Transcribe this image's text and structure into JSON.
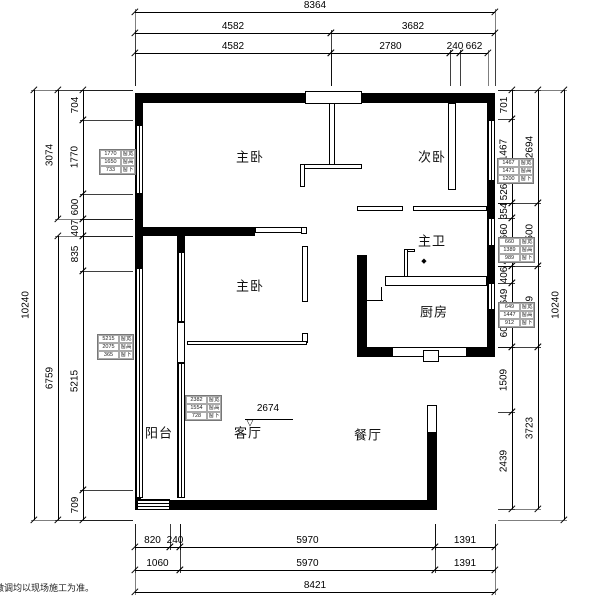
{
  "footnote": "微调均以现场施工为准。",
  "colors": {
    "wall": "#000000",
    "line": "#000000",
    "background": "#ffffff"
  },
  "plan": {
    "rooms": [
      {
        "id": "master-bedroom-top",
        "label": "主卧",
        "x": 250,
        "y": 156
      },
      {
        "id": "second-bedroom",
        "label": "次卧",
        "x": 432,
        "y": 156
      },
      {
        "id": "master-bath",
        "label": "主卫",
        "x": 432,
        "y": 240
      },
      {
        "id": "kitchen",
        "label": "厨房",
        "x": 434,
        "y": 311
      },
      {
        "id": "master-bedroom-mid",
        "label": "主卧",
        "x": 250,
        "y": 285
      },
      {
        "id": "balcony",
        "label": "阳台",
        "x": 159,
        "y": 432
      },
      {
        "id": "living-room",
        "label": "客厅",
        "x": 248,
        "y": 432
      },
      {
        "id": "dining-room",
        "label": "餐厅",
        "x": 368,
        "y": 434
      }
    ],
    "level_mark": {
      "value": "2674",
      "text_x": 268,
      "text_y": 414,
      "line_x1": 245,
      "line_x2": 293,
      "line_y": 419,
      "tri_x": 250,
      "tri_y": 423
    },
    "diamond_mark": {
      "x": 424,
      "y": 261
    },
    "walls": [
      {
        "x": 135,
        "y": 93,
        "w": 170,
        "h": 10,
        "t": "s"
      },
      {
        "x": 362,
        "y": 93,
        "w": 133,
        "h": 10,
        "t": "s"
      },
      {
        "x": 305,
        "y": 91,
        "w": 57,
        "h": 13,
        "t": "o"
      },
      {
        "x": 487,
        "y": 93,
        "w": 8,
        "h": 27,
        "t": "s"
      },
      {
        "x": 487,
        "y": 181,
        "w": 8,
        "h": 37,
        "t": "s"
      },
      {
        "x": 487,
        "y": 246,
        "w": 8,
        "h": 37,
        "t": "s"
      },
      {
        "x": 487,
        "y": 310,
        "w": 8,
        "h": 37,
        "t": "s"
      },
      {
        "x": 392,
        "y": 347,
        "w": 75,
        "h": 10,
        "t": "o"
      },
      {
        "x": 423,
        "y": 350,
        "w": 16,
        "h": 12,
        "t": "o"
      },
      {
        "x": 467,
        "y": 347,
        "w": 28,
        "h": 10,
        "t": "s"
      },
      {
        "x": 427,
        "y": 405,
        "w": 10,
        "h": 28,
        "t": "o"
      },
      {
        "x": 427,
        "y": 432,
        "w": 10,
        "h": 78,
        "t": "s"
      },
      {
        "x": 170,
        "y": 500,
        "w": 267,
        "h": 10,
        "t": "s"
      },
      {
        "x": 135,
        "y": 497,
        "w": 6,
        "h": 13,
        "t": "s"
      },
      {
        "x": 135,
        "y": 93,
        "w": 8,
        "h": 32,
        "t": "s"
      },
      {
        "x": 135,
        "y": 194,
        "w": 8,
        "h": 42,
        "t": "s"
      },
      {
        "x": 135,
        "y": 236,
        "w": 8,
        "h": 32,
        "t": "s"
      },
      {
        "x": 135,
        "y": 227,
        "w": 120,
        "h": 9,
        "t": "s"
      },
      {
        "x": 255,
        "y": 227,
        "w": 52,
        "h": 6,
        "t": "o"
      },
      {
        "x": 301,
        "y": 227,
        "w": 6,
        "h": 7,
        "t": "o"
      },
      {
        "x": 302,
        "y": 246,
        "w": 6,
        "h": 56,
        "t": "o"
      },
      {
        "x": 302,
        "y": 333,
        "w": 6,
        "h": 10,
        "t": "o"
      },
      {
        "x": 187,
        "y": 341,
        "w": 120,
        "h": 4,
        "t": "o"
      },
      {
        "x": 329,
        "y": 103,
        "w": 6,
        "h": 65,
        "t": "o"
      },
      {
        "x": 300,
        "y": 164,
        "w": 62,
        "h": 5,
        "t": "o"
      },
      {
        "x": 300,
        "y": 164,
        "w": 5,
        "h": 23,
        "t": "o"
      },
      {
        "x": 448,
        "y": 103,
        "w": 8,
        "h": 87,
        "t": "o"
      },
      {
        "x": 357,
        "y": 206,
        "w": 46,
        "h": 5,
        "t": "o"
      },
      {
        "x": 413,
        "y": 206,
        "w": 74,
        "h": 5,
        "t": "o"
      },
      {
        "x": 404,
        "y": 249,
        "w": 11,
        "h": 3,
        "t": "o"
      },
      {
        "x": 404,
        "y": 249,
        "w": 4,
        "h": 28,
        "t": "o"
      },
      {
        "x": 385,
        "y": 276,
        "w": 102,
        "h": 10,
        "t": "o"
      },
      {
        "x": 357,
        "y": 255,
        "w": 10,
        "h": 92,
        "t": "s"
      },
      {
        "x": 357,
        "y": 347,
        "w": 35,
        "h": 10,
        "t": "s"
      },
      {
        "x": 367,
        "y": 300,
        "w": 16,
        "h": 1,
        "t": "s"
      },
      {
        "x": 381,
        "y": 287,
        "w": 1,
        "h": 14,
        "t": "s"
      },
      {
        "x": 177,
        "y": 236,
        "w": 8,
        "h": 16,
        "t": "s"
      },
      {
        "x": 177,
        "y": 322,
        "w": 8,
        "h": 41,
        "t": "o"
      }
    ],
    "windows": [
      {
        "x": 135,
        "y": 125,
        "w": 8,
        "h": 69,
        "o": "v"
      },
      {
        "x": 135,
        "y": 268,
        "w": 8,
        "h": 230,
        "o": "v"
      },
      {
        "x": 487,
        "y": 120,
        "w": 8,
        "h": 61,
        "o": "v"
      },
      {
        "x": 487,
        "y": 218,
        "w": 8,
        "h": 28,
        "o": "v"
      },
      {
        "x": 487,
        "y": 283,
        "w": 8,
        "h": 27,
        "o": "v"
      },
      {
        "x": 177,
        "y": 252,
        "w": 8,
        "h": 70,
        "o": "v"
      },
      {
        "x": 177,
        "y": 363,
        "w": 8,
        "h": 135,
        "o": "v"
      },
      {
        "x": 137,
        "y": 499,
        "w": 33,
        "h": 11,
        "o": "h"
      }
    ],
    "h_dims": [
      {
        "label": "8364",
        "x1": 135,
        "x2": 495,
        "y": 12
      },
      {
        "label": "4582",
        "x1": 135,
        "x2": 331,
        "y": 33
      },
      {
        "label": "3682",
        "x1": 331,
        "x2": 495,
        "y": 33
      },
      {
        "label": "4582",
        "x1": 135,
        "x2": 331,
        "y": 53
      },
      {
        "label": "2780",
        "x1": 331,
        "x2": 450,
        "y": 53
      },
      {
        "label": "240",
        "x1": 450,
        "x2": 460,
        "y": 53
      },
      {
        "label": "662",
        "x1": 460,
        "x2": 488,
        "y": 53
      },
      {
        "label": "820",
        "x1": 135,
        "x2": 170,
        "y": 547
      },
      {
        "label": "240",
        "x1": 170,
        "x2": 180,
        "y": 547
      },
      {
        "label": "5970",
        "x1": 180,
        "x2": 435,
        "y": 547
      },
      {
        "label": "1391",
        "x1": 435,
        "x2": 495,
        "y": 547
      },
      {
        "label": "1060",
        "x1": 135,
        "x2": 180,
        "y": 570
      },
      {
        "label": "5970",
        "x1": 180,
        "x2": 435,
        "y": 570
      },
      {
        "label": "1391",
        "x1": 435,
        "x2": 495,
        "y": 570
      },
      {
        "label": "8421",
        "x1": 135,
        "x2": 495,
        "y": 592
      }
    ],
    "v_dims": [
      {
        "label": "10240",
        "y1": 90,
        "y2": 520,
        "x": 34
      },
      {
        "label": "3074",
        "y1": 90,
        "y2": 219,
        "x": 58
      },
      {
        "label": "6759",
        "y1": 236,
        "y2": 520,
        "x": 58
      },
      {
        "label": "704",
        "y1": 90,
        "y2": 120,
        "x": 83
      },
      {
        "label": "1770",
        "y1": 120,
        "y2": 194,
        "x": 83
      },
      {
        "label": "600",
        "y1": 194,
        "y2": 219,
        "x": 83
      },
      {
        "label": "407",
        "y1": 219,
        "y2": 236,
        "x": 83
      },
      {
        "label": "835",
        "y1": 236,
        "y2": 271,
        "x": 83
      },
      {
        "label": "5215",
        "y1": 271,
        "y2": 490,
        "x": 83
      },
      {
        "label": "709",
        "y1": 490,
        "y2": 520,
        "x": 83
      },
      {
        "label": "701",
        "y1": 90,
        "y2": 119,
        "x": 512
      },
      {
        "label": "1467",
        "y1": 119,
        "y2": 181,
        "x": 512
      },
      {
        "label": "526",
        "y1": 181,
        "y2": 203,
        "x": 512
      },
      {
        "label": "354",
        "y1": 203,
        "y2": 218,
        "x": 512
      },
      {
        "label": "660",
        "y1": 218,
        "y2": 246,
        "x": 512
      },
      {
        "label": "486",
        "y1": 246,
        "y2": 266,
        "x": 512
      },
      {
        "label": "406",
        "y1": 266,
        "y2": 283,
        "x": 512
      },
      {
        "label": "649",
        "y1": 283,
        "y2": 310,
        "x": 512
      },
      {
        "label": "604",
        "y1": 310,
        "y2": 347,
        "x": 512
      },
      {
        "label": "1509",
        "y1": 347,
        "y2": 412,
        "x": 512
      },
      {
        "label": "2439",
        "y1": 412,
        "y2": 509,
        "x": 512
      },
      {
        "label": "2694",
        "y1": 90,
        "y2": 203,
        "x": 538
      },
      {
        "label": "1500",
        "y1": 203,
        "y2": 266,
        "x": 538
      },
      {
        "label": "1659",
        "y1": 266,
        "y2": 347,
        "x": 538
      },
      {
        "label": "3723",
        "y1": 347,
        "y2": 509,
        "x": 538
      },
      {
        "label": "10240",
        "y1": 90,
        "y2": 520,
        "x": 564
      }
    ],
    "window_tables": [
      {
        "x": 99,
        "y": 149,
        "rows": [
          [
            "1770",
            "窗宽"
          ],
          [
            "1650",
            "窗高"
          ],
          [
            "733",
            "窗下"
          ]
        ]
      },
      {
        "x": 97,
        "y": 334,
        "rows": [
          [
            "5215",
            "窗宽"
          ],
          [
            "2075",
            "窗高"
          ],
          [
            "365",
            "窗下"
          ]
        ]
      },
      {
        "x": 497,
        "y": 158,
        "rows": [
          [
            "1467",
            "窗宽"
          ],
          [
            "1471",
            "窗高"
          ],
          [
            "1200",
            "窗下"
          ]
        ]
      },
      {
        "x": 498,
        "y": 237,
        "rows": [
          [
            "660",
            "窗宽"
          ],
          [
            "1389",
            "窗高"
          ],
          [
            "989",
            "窗下"
          ]
        ]
      },
      {
        "x": 498,
        "y": 302,
        "rows": [
          [
            "649",
            "窗宽"
          ],
          [
            "1447",
            "窗高"
          ],
          [
            "912",
            "窗下"
          ]
        ]
      },
      {
        "x": 185,
        "y": 395,
        "rows": [
          [
            "2382",
            "窗宽"
          ],
          [
            "1554",
            "窗高"
          ],
          [
            "728",
            "窗下"
          ]
        ]
      }
    ]
  }
}
